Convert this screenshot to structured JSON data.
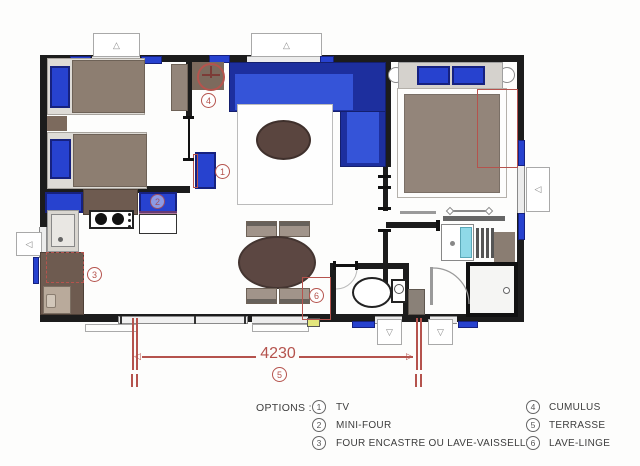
{
  "plan": {
    "dimension": {
      "value": "4230",
      "option_ref": "5"
    },
    "markers": {
      "tv": "1",
      "mini_four": "2",
      "dishwasher": "3",
      "cumulus": "4",
      "terrasse": "5",
      "lave_linge": "6"
    }
  },
  "legend": {
    "title": "OPTIONS :",
    "col1": [
      {
        "num": "1",
        "label": "TV"
      },
      {
        "num": "2",
        "label": "MINI-FOUR"
      },
      {
        "num": "3",
        "label": "FOUR ENCASTRE OU LAVE-VAISSELLE"
      }
    ],
    "col2": [
      {
        "num": "4",
        "label": "CUMULUS"
      },
      {
        "num": "5",
        "label": "TERRASSE"
      },
      {
        "num": "6",
        "label": "LAVE-LINGE"
      }
    ]
  },
  "icons": {
    "window_marker_up": "△",
    "window_marker_down": "▽",
    "window_marker_left": "◁",
    "dim_arrow_left": "◁",
    "dim_arrow_right": "▷"
  },
  "colors": {
    "wall": "#1c1c1c",
    "blue": "#2742cf",
    "blue_dark": "#16217f",
    "blue_seat": "#3554d8",
    "red": "#b5534d",
    "brown_counter": "#6e5b50",
    "brown_bed": "#8d7e71",
    "brown_table": "#5c4742",
    "taupe": "#93857a",
    "cyan_mirror": "#8fd9e8",
    "yellow": "#e3e67c"
  }
}
